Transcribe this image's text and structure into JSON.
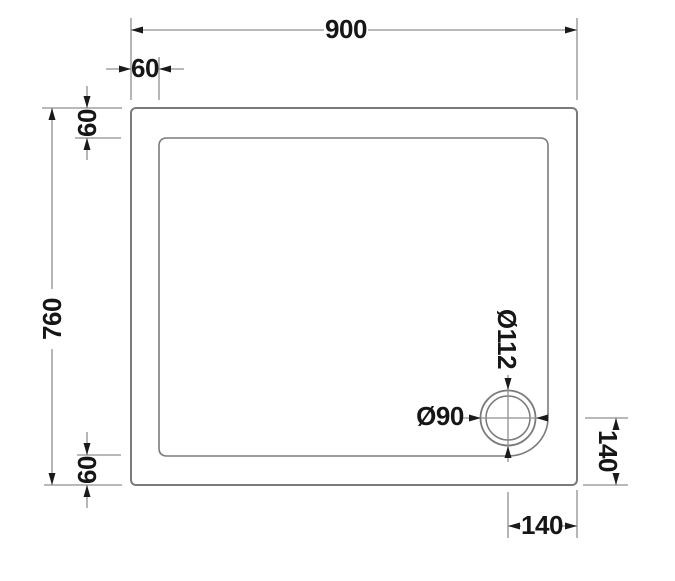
{
  "drawing": {
    "description": "Plan-view technical drawing of a rectangular shower tray with corner waste",
    "dims": {
      "overall_width": "900",
      "overall_height": "760",
      "corner_inset_horizontal": "60",
      "rim_top": "60",
      "rim_bottom": "60",
      "waste_outer_dia": "Ø112",
      "waste_inner_dia": "Ø90",
      "waste_from_right": "140",
      "waste_from_bottom": "140"
    },
    "colors": {
      "background": "#ffffff",
      "tray_outline": "#7b7b7b",
      "dimension_lines": "#8f8f8f",
      "text_and_arrows": "#161616"
    }
  }
}
